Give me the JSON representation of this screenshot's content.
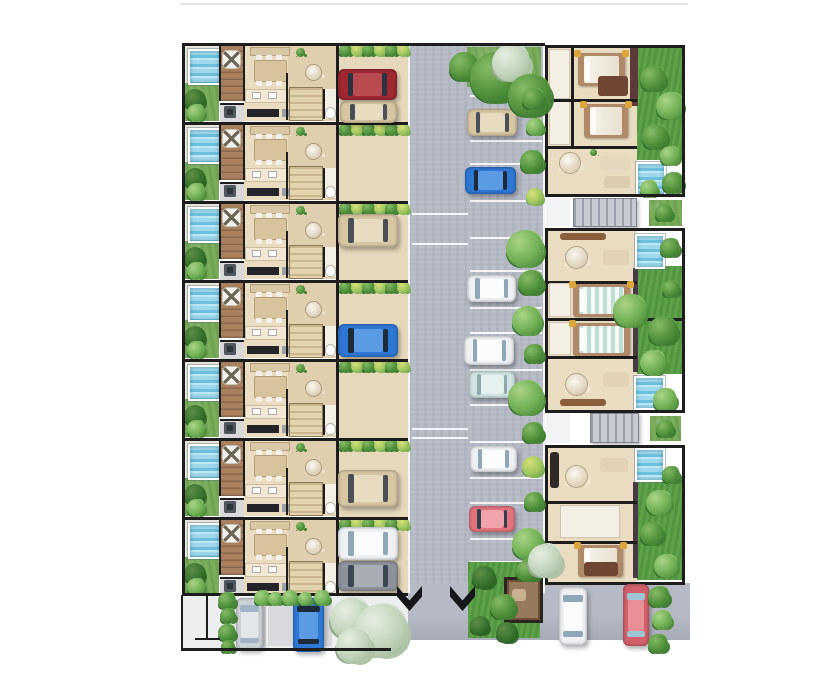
{
  "meta": {
    "type": "architectural-site-plan",
    "description": "Top-down rendered site plan: a column of seven townhouse units with plunge pools and driveways on the left, a central parking drive with cars and landscaping, three larger villa blocks with pools and lawns on the right, and an entry street with parked cars along the bottom.",
    "background": "#ffffff"
  },
  "palette": {
    "road": "#b6bac5",
    "pavement": "#eceef0",
    "pavement_dark": "#d7d9dd",
    "driveway": "#e6d8ba",
    "floor": "#e9dcc1",
    "floor_dark": "#e0cfae",
    "bath": "#f4efe5",
    "wall": "#1d1d1d",
    "grass": "#79ad5a",
    "lawn": "#5ea24a",
    "pool_water": "#9fd8ea",
    "deck": "#a8805e",
    "stairs": "#c7cad1",
    "gazebo": "#6e4f36",
    "cars": {
      "red": {
        "body": "#9e2730",
        "roof": "#b94a50",
        "glass": "#2c3340"
      },
      "beige": {
        "body": "#d6c6a2",
        "roof": "#e8dcc0",
        "glass": "#4a4f58"
      },
      "blue": {
        "body": "#2e77d3",
        "roof": "#5b9be4",
        "glass": "#1d2a3a"
      },
      "white": {
        "body": "#eef0f3",
        "roof": "#fbfcfd",
        "glass": "#8fa6b6"
      },
      "teal": {
        "body": "#cfe4e2",
        "roof": "#e4f1ef",
        "glass": "#8fa8ad"
      },
      "pink": {
        "body": "#e2737f",
        "roof": "#f0a3ab",
        "glass": "#32404e"
      },
      "silver": {
        "body": "#cdd1d6",
        "roof": "#e2e5e9",
        "glass": "#9fb4c4"
      },
      "gray": {
        "body": "#8e939b",
        "roof": "#a9adb3",
        "glass": "#3c4754"
      },
      "coral": {
        "body": "#d2606a",
        "roof": "#e98f97",
        "glass": "#9fc4d4"
      }
    }
  },
  "left_units": {
    "row_ys": [
      43,
      122,
      201,
      280,
      359,
      438,
      517
    ],
    "row_h": 79,
    "bottom": 593,
    "x": {
      "border": 182,
      "garden": 185,
      "gardenW": 34,
      "deck": 220,
      "deckW": 24,
      "interior": 244,
      "interiorEnd": 336,
      "driveway": 338,
      "drivewayEnd": 408
    }
  },
  "driveway_cars": [
    {
      "color": "red",
      "x": 338,
      "y": 69,
      "w": 59,
      "h": 31
    },
    {
      "color": "beige",
      "x": 340,
      "y": 101,
      "w": 57,
      "h": 22
    },
    {
      "color": "beige",
      "x": 338,
      "y": 214,
      "w": 60,
      "h": 33
    },
    {
      "color": "blue",
      "x": 338,
      "y": 324,
      "w": 60,
      "h": 33
    },
    {
      "color": "beige",
      "x": 338,
      "y": 470,
      "w": 60,
      "h": 37
    },
    {
      "color": "white",
      "x": 338,
      "y": 527,
      "w": 60,
      "h": 33
    },
    {
      "color": "gray",
      "x": 338,
      "y": 561,
      "w": 60,
      "h": 30
    }
  ],
  "road": {
    "x": 408,
    "y": 43,
    "w": 137,
    "h": 550,
    "bottom_road": {
      "x": 388,
      "y": 583,
      "w": 302,
      "h": 57
    },
    "stall_lines_right": {
      "x": 470,
      "w": 72,
      "ys": [
        95,
        140,
        163,
        200,
        237,
        270,
        307,
        332,
        369,
        404,
        441,
        477,
        502,
        538,
        561
      ]
    },
    "stall_lines_left": {
      "x": 412,
      "w": 56,
      "ys": [
        213,
        243,
        428,
        437
      ]
    },
    "cars": [
      {
        "color": "beige",
        "x": 467,
        "y": 109,
        "w": 50,
        "h": 27
      },
      {
        "color": "blue",
        "x": 465,
        "y": 167,
        "w": 51,
        "h": 27
      },
      {
        "color": "white",
        "x": 467,
        "y": 275,
        "w": 49,
        "h": 27
      },
      {
        "color": "white",
        "x": 464,
        "y": 336,
        "w": 50,
        "h": 29
      },
      {
        "color": "teal",
        "x": 469,
        "y": 371,
        "w": 46,
        "h": 27
      },
      {
        "color": "white",
        "x": 470,
        "y": 446,
        "w": 47,
        "h": 26
      },
      {
        "color": "pink",
        "x": 469,
        "y": 506,
        "w": 46,
        "h": 26
      }
    ],
    "top_green": {
      "x": 467,
      "y": 47,
      "w": 74,
      "h": 40
    },
    "trees": [
      {
        "x": 449,
        "y": 52,
        "d": 30,
        "v": "green"
      },
      {
        "x": 470,
        "y": 52,
        "d": 52,
        "v": "green"
      },
      {
        "x": 492,
        "y": 44,
        "d": 38,
        "v": "pale"
      },
      {
        "x": 508,
        "y": 74,
        "d": 44,
        "v": "green"
      }
    ],
    "hedge_bushes": [
      {
        "x": 522,
        "y": 88,
        "d": 22,
        "v": "green"
      },
      {
        "x": 526,
        "y": 118,
        "d": 18,
        "v": "light"
      },
      {
        "x": 520,
        "y": 150,
        "d": 24,
        "v": "green"
      },
      {
        "x": 526,
        "y": 188,
        "d": 18,
        "v": "yellow"
      },
      {
        "x": 506,
        "y": 230,
        "d": 38,
        "v": "light"
      },
      {
        "x": 518,
        "y": 270,
        "d": 26,
        "v": "green"
      },
      {
        "x": 512,
        "y": 306,
        "d": 30,
        "v": "light"
      },
      {
        "x": 524,
        "y": 344,
        "d": 20,
        "v": "green"
      },
      {
        "x": 508,
        "y": 380,
        "d": 36,
        "v": "light"
      },
      {
        "x": 522,
        "y": 422,
        "d": 22,
        "v": "green"
      },
      {
        "x": 522,
        "y": 456,
        "d": 22,
        "v": "yellow"
      },
      {
        "x": 524,
        "y": 492,
        "d": 20,
        "v": "green"
      },
      {
        "x": 512,
        "y": 528,
        "d": 32,
        "v": "light"
      },
      {
        "x": 518,
        "y": 558,
        "d": 24,
        "v": "green"
      }
    ]
  },
  "right_blocks": [
    {
      "name": "villa-block-top",
      "frame": {
        "x": 545,
        "y": 45,
        "w": 140,
        "h": 152
      },
      "interior": {
        "x": 548,
        "y": 48,
        "w": 89,
        "h": 146
      },
      "garden": {
        "x": 637,
        "y": 48,
        "w": 45,
        "h": 112
      },
      "pools": [
        {
          "x": 636,
          "y": 162,
          "w": 26,
          "h": 30
        }
      ],
      "accent_wall": {
        "x": 630,
        "y": 48,
        "w": 8,
        "h": 58,
        "c": "#5c3a3a"
      },
      "rooms": [
        {
          "t": "bath",
          "x": 549,
          "y": 49,
          "w": 21,
          "h": 50
        },
        {
          "t": "bath",
          "x": 549,
          "y": 101,
          "w": 21,
          "h": 44
        },
        {
          "t": "wallh",
          "x": 548,
          "y": 99,
          "w": 89
        },
        {
          "t": "wallh",
          "x": 548,
          "y": 146,
          "w": 89
        },
        {
          "t": "wallv",
          "x": 571,
          "y": 48,
          "h": 98
        },
        {
          "t": "bed",
          "x": 578,
          "y": 53,
          "w": 47,
          "h": 33,
          "mat": "white"
        },
        {
          "t": "sofa",
          "x": 598,
          "y": 76,
          "w": 30,
          "h": 20,
          "c": "#6e4632"
        },
        {
          "t": "bed",
          "x": 584,
          "y": 104,
          "w": 44,
          "h": 34,
          "mat": "white"
        },
        {
          "t": "rtable",
          "x": 560,
          "y": 153,
          "d": 20
        },
        {
          "t": "sofa",
          "x": 600,
          "y": 156,
          "w": 30,
          "h": 14,
          "c": "#e4d7bd"
        },
        {
          "t": "sofa",
          "x": 604,
          "y": 176,
          "w": 26,
          "h": 12,
          "c": "#dcccb0"
        },
        {
          "t": "plant",
          "x": 590,
          "y": 149,
          "d": 7
        }
      ],
      "garden_bushes": [
        {
          "x": 640,
          "y": 66,
          "d": 26,
          "v": "green"
        },
        {
          "x": 656,
          "y": 92,
          "d": 28,
          "v": "light"
        },
        {
          "x": 642,
          "y": 124,
          "d": 26,
          "v": "green"
        },
        {
          "x": 660,
          "y": 146,
          "d": 20,
          "v": "light"
        },
        {
          "x": 662,
          "y": 172,
          "d": 22,
          "v": "green"
        },
        {
          "x": 640,
          "y": 180,
          "d": 18,
          "v": "light"
        }
      ]
    },
    {
      "name": "villa-block-middle",
      "frame": {
        "x": 545,
        "y": 228,
        "w": 140,
        "h": 185
      },
      "interior": {
        "x": 548,
        "y": 231,
        "w": 89,
        "h": 179
      },
      "garden": {
        "x": 637,
        "y": 266,
        "w": 45,
        "h": 108
      },
      "pools": [
        {
          "x": 635,
          "y": 234,
          "w": 26,
          "h": 31
        },
        {
          "x": 634,
          "y": 376,
          "w": 27,
          "h": 30
        }
      ],
      "accent_wall": {
        "x": 633,
        "y": 268,
        "w": 5,
        "h": 104,
        "c": "#4a3a44"
      },
      "rooms": [
        {
          "t": "wallh",
          "x": 548,
          "y": 281,
          "w": 89
        },
        {
          "t": "wallh",
          "x": 548,
          "y": 318,
          "w": 137
        },
        {
          "t": "wallh",
          "x": 548,
          "y": 356,
          "w": 89
        },
        {
          "t": "bath",
          "x": 549,
          "y": 283,
          "w": 22,
          "h": 34
        },
        {
          "t": "bath",
          "x": 549,
          "y": 322,
          "w": 22,
          "h": 33
        },
        {
          "t": "sofa",
          "x": 560,
          "y": 233,
          "w": 46,
          "h": 7,
          "c": "#8a5d3d"
        },
        {
          "t": "rtable",
          "x": 566,
          "y": 247,
          "d": 21
        },
        {
          "t": "sofa",
          "x": 603,
          "y": 250,
          "w": 26,
          "h": 15,
          "c": "#e2d3b6"
        },
        {
          "t": "bed",
          "x": 573,
          "y": 284,
          "w": 57,
          "h": 33,
          "mat": "teal"
        },
        {
          "t": "bed",
          "x": 573,
          "y": 323,
          "w": 57,
          "h": 33,
          "mat": "teal"
        },
        {
          "t": "rtable",
          "x": 566,
          "y": 374,
          "d": 21
        },
        {
          "t": "sofa",
          "x": 603,
          "y": 372,
          "w": 26,
          "h": 15,
          "c": "#e2d3b6"
        },
        {
          "t": "sofa",
          "x": 560,
          "y": 399,
          "w": 46,
          "h": 7,
          "c": "#8a5d3d"
        }
      ],
      "garden_bushes": [
        {
          "x": 613,
          "y": 294,
          "d": 34,
          "v": "light"
        },
        {
          "x": 648,
          "y": 316,
          "d": 30,
          "v": "green"
        },
        {
          "x": 640,
          "y": 350,
          "d": 26,
          "v": "light"
        },
        {
          "x": 660,
          "y": 238,
          "d": 20,
          "v": "green"
        },
        {
          "x": 653,
          "y": 388,
          "d": 24,
          "v": "light"
        },
        {
          "x": 662,
          "y": 280,
          "d": 18,
          "v": "green"
        }
      ]
    },
    {
      "name": "villa-block-bottom",
      "frame": {
        "x": 545,
        "y": 445,
        "w": 140,
        "h": 140
      },
      "interior": {
        "x": 548,
        "y": 448,
        "w": 89,
        "h": 134
      },
      "garden": {
        "x": 637,
        "y": 480,
        "w": 45,
        "h": 100
      },
      "pools": [
        {
          "x": 635,
          "y": 448,
          "w": 26,
          "h": 30
        }
      ],
      "accent_wall": {
        "x": 633,
        "y": 482,
        "w": 5,
        "h": 96,
        "c": "#4a3a44"
      },
      "rooms": [
        {
          "t": "wallh",
          "x": 548,
          "y": 501,
          "w": 89
        },
        {
          "t": "wallh",
          "x": 548,
          "y": 541,
          "w": 89
        },
        {
          "t": "sofa",
          "x": 550,
          "y": 452,
          "w": 9,
          "h": 36,
          "c": "#2e2a26"
        },
        {
          "t": "rtable",
          "x": 566,
          "y": 466,
          "d": 21
        },
        {
          "t": "sofa",
          "x": 600,
          "y": 458,
          "w": 28,
          "h": 14,
          "c": "#e2d3b6"
        },
        {
          "t": "bath",
          "x": 560,
          "y": 505,
          "w": 60,
          "h": 33
        },
        {
          "t": "bed",
          "x": 578,
          "y": 545,
          "w": 45,
          "h": 32,
          "mat": "white"
        },
        {
          "t": "sofa",
          "x": 584,
          "y": 562,
          "w": 34,
          "h": 14,
          "c": "#6e4632"
        }
      ],
      "garden_bushes": [
        {
          "x": 646,
          "y": 490,
          "d": 26,
          "v": "light"
        },
        {
          "x": 640,
          "y": 522,
          "d": 24,
          "v": "green"
        },
        {
          "x": 654,
          "y": 554,
          "d": 24,
          "v": "light"
        },
        {
          "x": 662,
          "y": 466,
          "d": 18,
          "v": "green"
        }
      ]
    }
  ],
  "between_blocks": [
    {
      "stairs": {
        "x": 573,
        "y": 198,
        "w": 62,
        "h": 27
      },
      "green": {
        "x": 649,
        "y": 200,
        "w": 33,
        "h": 26
      },
      "walk": {
        "x": 546,
        "y": 198,
        "w": 24,
        "h": 28
      }
    },
    {
      "stairs": {
        "x": 590,
        "y": 413,
        "w": 47,
        "h": 28
      },
      "green": {
        "x": 650,
        "y": 416,
        "w": 31,
        "h": 25
      },
      "walk": {
        "x": 546,
        "y": 413,
        "w": 24,
        "h": 30
      }
    }
  ],
  "bottom_street": {
    "pavement": {
      "x": 183,
      "y": 595,
      "w": 225,
      "h": 55
    },
    "pavement_dark": {
      "x": 262,
      "y": 596,
      "w": 70,
      "h": 50
    },
    "chevrons": [
      {
        "x": 397,
        "y": 586,
        "w": 25,
        "h": 25
      },
      {
        "x": 450,
        "y": 586,
        "w": 25,
        "h": 25
      }
    ],
    "park": {
      "x": 468,
      "y": 562,
      "w": 72,
      "h": 76
    },
    "gazebo": {
      "x": 504,
      "y": 577,
      "w": 33,
      "h": 40
    },
    "park_bushes": [
      {
        "x": 472,
        "y": 566,
        "d": 24,
        "v": "dark"
      },
      {
        "x": 490,
        "y": 594,
        "d": 26,
        "v": "green"
      },
      {
        "x": 470,
        "y": 616,
        "d": 20,
        "v": "dark"
      },
      {
        "x": 516,
        "y": 560,
        "d": 22,
        "v": "green"
      },
      {
        "x": 496,
        "y": 622,
        "d": 22,
        "v": "dark"
      },
      {
        "x": 528,
        "y": 544,
        "d": 34,
        "v": "pale"
      }
    ],
    "hedge_v": [
      {
        "x": 218,
        "y": 592,
        "d": 18
      },
      {
        "x": 220,
        "y": 608,
        "d": 16
      },
      {
        "x": 218,
        "y": 624,
        "d": 18
      },
      {
        "x": 221,
        "y": 640,
        "d": 14
      }
    ],
    "hedge_h": [
      {
        "x": 254,
        "y": 590,
        "d": 16
      },
      {
        "x": 268,
        "y": 592,
        "d": 14
      },
      {
        "x": 282,
        "y": 590,
        "d": 16
      },
      {
        "x": 298,
        "y": 592,
        "d": 14
      },
      {
        "x": 314,
        "y": 590,
        "d": 16
      }
    ],
    "pale_trees": [
      {
        "x": 330,
        "y": 598,
        "d": 42
      },
      {
        "x": 354,
        "y": 604,
        "d": 54
      },
      {
        "x": 336,
        "y": 628,
        "d": 36
      }
    ],
    "right_hedge": [
      {
        "x": 648,
        "y": 586,
        "d": 22,
        "v": "green"
      },
      {
        "x": 652,
        "y": 610,
        "d": 20,
        "v": "light"
      },
      {
        "x": 648,
        "y": 634,
        "d": 20,
        "v": "green"
      }
    ],
    "cars": [
      {
        "color": "silver",
        "x": 236,
        "y": 598,
        "w": 27,
        "h": 52,
        "orient": "v"
      },
      {
        "color": "blue",
        "x": 293,
        "y": 598,
        "w": 31,
        "h": 54,
        "orient": "v"
      },
      {
        "color": "white",
        "x": 559,
        "y": 587,
        "w": 28,
        "h": 58,
        "orient": "v"
      },
      {
        "color": "coral",
        "x": 623,
        "y": 584,
        "w": 26,
        "h": 62,
        "orient": "v"
      }
    ],
    "marker": {
      "vline": {
        "x": 206,
        "y": 596,
        "h": 42
      },
      "cap": {
        "x": 195,
        "y": 638,
        "w": 25
      }
    },
    "borders": {
      "left": {
        "x": 181,
        "y": 595,
        "h": 55
      },
      "bottom": {
        "x": 181,
        "y": 648,
        "w": 210
      }
    }
  },
  "borders": {
    "faint_top": {
      "x": 180,
      "y": 3,
      "w": 508,
      "h": 2
    },
    "top": {
      "x": 182,
      "y": 43,
      "w": 363,
      "h": 3
    },
    "left": {
      "x": 182,
      "y": 43,
      "w": 3,
      "h": 552
    },
    "units_bottom": {
      "x": 182,
      "y": 593,
      "w": 226,
      "h": 3
    },
    "mid_wall_x": 336,
    "curb": {
      "x": 408,
      "y": 43,
      "w": 2,
      "h": 550
    }
  }
}
